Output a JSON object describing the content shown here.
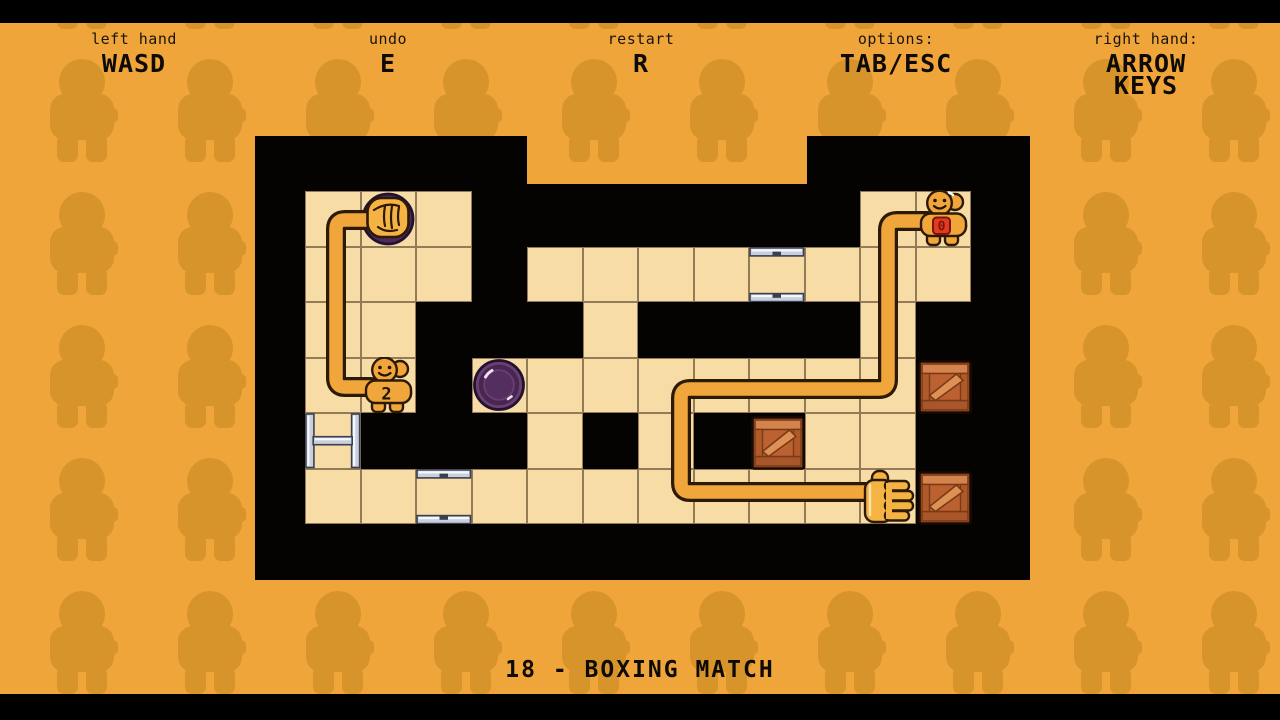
{
  "hud": {
    "controls": [
      {
        "slug": "left-hand",
        "label": "left hand",
        "keys": "WASD",
        "keys_display": "WASD"
      },
      {
        "slug": "undo",
        "label": "undo",
        "keys": "E",
        "keys_display": "E"
      },
      {
        "slug": "restart",
        "label": "restart",
        "keys": "R",
        "keys_display": "R"
      },
      {
        "slug": "options",
        "label": "options:",
        "keys": "TAB/ESC",
        "keys_display": "TAB/ESC"
      },
      {
        "slug": "right-hand",
        "label": "right hand:",
        "keys": "ARROW KEYS",
        "keys_display": "ARROW\nKEYS"
      }
    ],
    "level_title": "18 - BOXING MATCH"
  },
  "board": {
    "grid": [
      "FPF.......FF",
      "FFF.FFFFVFFF",
      "FF...F....F.",
      "FF.BFFFFFFF.",
      "H...F.F..FF.",
      "FFVFFFFFFFF."
    ],
    "legend": {
      ".": "void",
      "F": "floor",
      "P": "button-pressed",
      "B": "button-raised",
      "H": "rail-tile-sides",
      "V": "rail-tile-top-bottom"
    },
    "entities": [
      {
        "type": "crate",
        "name": "crate",
        "row": 3,
        "col": 11
      },
      {
        "type": "crate",
        "name": "crate",
        "row": 4,
        "col": 8
      },
      {
        "type": "crate",
        "name": "crate",
        "row": 5,
        "col": 11
      },
      {
        "type": "character",
        "name": "right-hand-character",
        "row": 0,
        "col": 11,
        "badge": "0",
        "badge_style": "red",
        "shine": true
      },
      {
        "type": "character",
        "name": "left-hand-character",
        "row": 3,
        "col": 1,
        "badge": "2",
        "badge_style": "plain",
        "shine": false
      },
      {
        "type": "fist",
        "name": "left-hand-fist-on-button",
        "row": 0,
        "col": 1
      },
      {
        "type": "open-hand",
        "name": "right-hand-open",
        "row": 5,
        "col": 10
      }
    ],
    "arms": {
      "left_arm": [
        [
          371,
          387
        ],
        [
          336,
          387
        ],
        [
          336,
          220
        ],
        [
          380,
          220
        ]
      ],
      "right_arm": [
        [
          928,
          221
        ],
        [
          888,
          221
        ],
        [
          888,
          389
        ],
        [
          681,
          389
        ],
        [
          681,
          492
        ],
        [
          870,
          492
        ]
      ]
    }
  },
  "colors": {
    "background": "#F0A53B",
    "background_silhouette": "#D6942A",
    "board_void": "#050302",
    "floor": "#F8DCA6",
    "grid_line": "#2B1A08",
    "arm": "#F1A63C",
    "arm_outline": "#2C1A06",
    "character": "#F1A63C",
    "hand": "#F5B344",
    "crate": "#BC6232",
    "crate_light": "#D5834C",
    "crate_dark": "#7B3A16",
    "button_purple": "#6A3E72",
    "button_pressed": "#4E2A57",
    "badge_red": "#E23A24",
    "rail_silver": "#C9CFDC",
    "hud_text": "#1B140B"
  }
}
